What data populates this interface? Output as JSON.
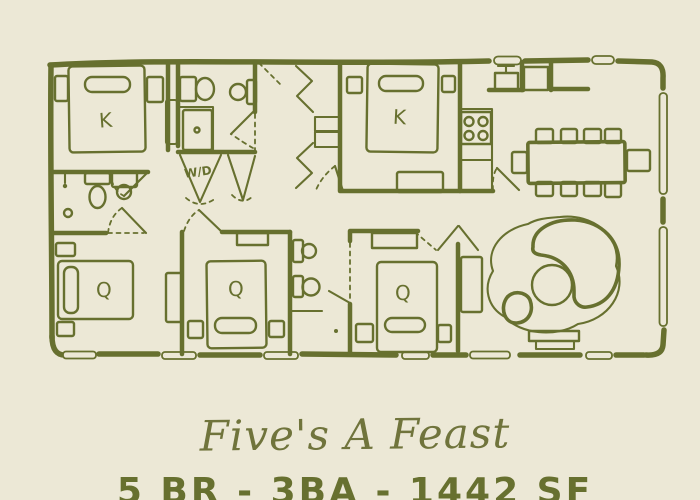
{
  "title": "Five's A Feast",
  "stats_line": "5 BR - 3BA - 1442 SF",
  "colors": {
    "background": "#ece8d6",
    "ink": "#67702f",
    "title": "#70743c"
  },
  "floorplan": {
    "labels": {
      "bedroom_1": "K",
      "bedroom_2": "K",
      "bedroom_3": "Q",
      "bedroom_4": "Q",
      "bedroom_5": "Q",
      "laundry": "W/D"
    }
  }
}
